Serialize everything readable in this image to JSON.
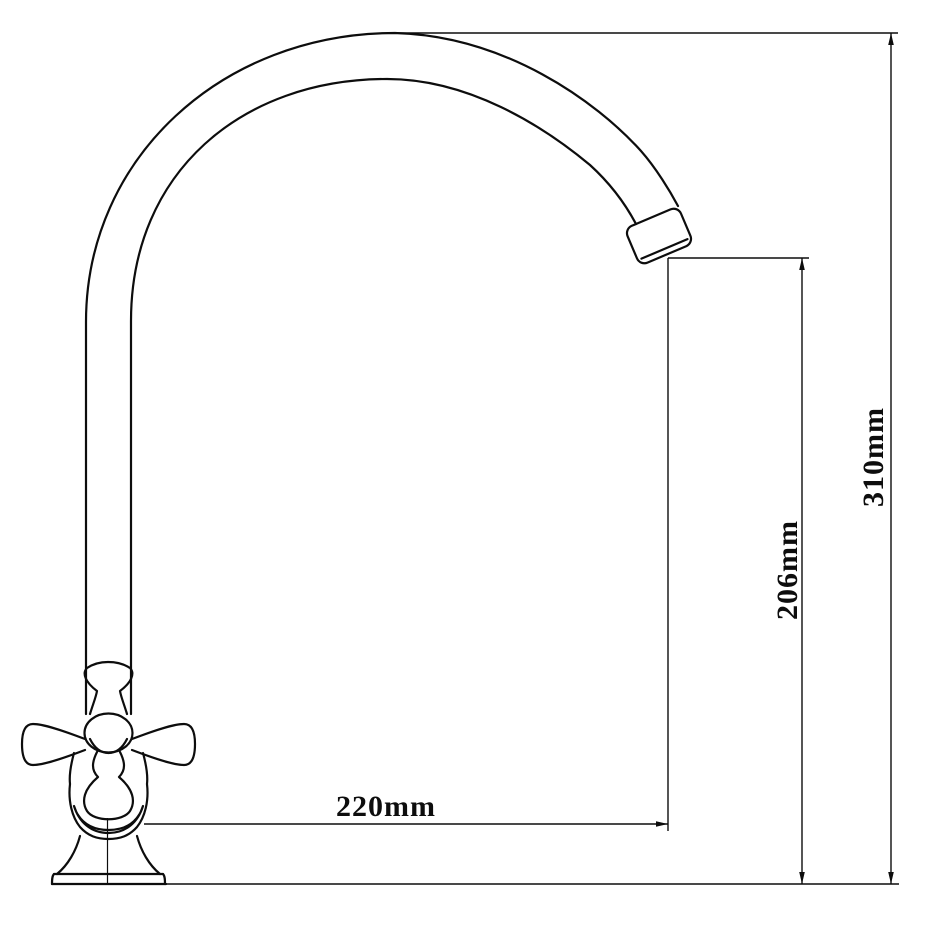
{
  "drawing": {
    "subject": "Gooseneck faucet with cross handle, front elevation",
    "style": "black line technical drawing on white"
  },
  "dimensions": {
    "total_height": {
      "label": "310mm",
      "orientation": "vertical"
    },
    "spout_outlet_height": {
      "label": "206mm",
      "orientation": "vertical"
    },
    "spout_reach": {
      "label": "220mm",
      "orientation": "horizontal"
    }
  },
  "colors": {
    "line": "#0d0d0d",
    "background": "#ffffff"
  }
}
